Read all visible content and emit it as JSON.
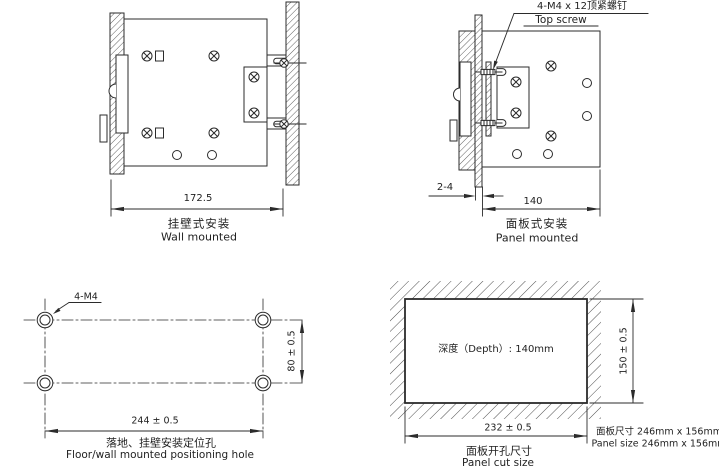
{
  "colors": {
    "line": "#2b2b2b",
    "background": "#ffffff"
  },
  "wall_mount": {
    "dim_width": "172.5",
    "label_zh": "挂壁式安装",
    "label_en": "Wall mounted"
  },
  "panel_mount": {
    "callout_line1": "4-M4 x 12顶紧螺钉",
    "callout_line2": "Top screw",
    "dim_panel_thickness": "2-4",
    "dim_depth": "140",
    "label_zh": "面板式安装",
    "label_en": "Panel mounted"
  },
  "positioning_holes": {
    "callout": "4-M4",
    "dim_width": "244 ± 0.5",
    "dim_height": "80 ± 0.5",
    "label_zh": "落地、挂壁安装定位孔",
    "label_en": "Floor/wall mounted positioning hole"
  },
  "panel_cut": {
    "depth_note": "深度（Depth）: 140mm",
    "dim_width": "232 ± 0.5",
    "dim_height": "150 ± 0.5",
    "label_zh": "面板开孔尺寸",
    "label_en": "Panel cut size",
    "panel_size_zh": "面板尺寸 246mm x 156mm",
    "panel_size_en": "Panel size 246mm x 156mm"
  }
}
